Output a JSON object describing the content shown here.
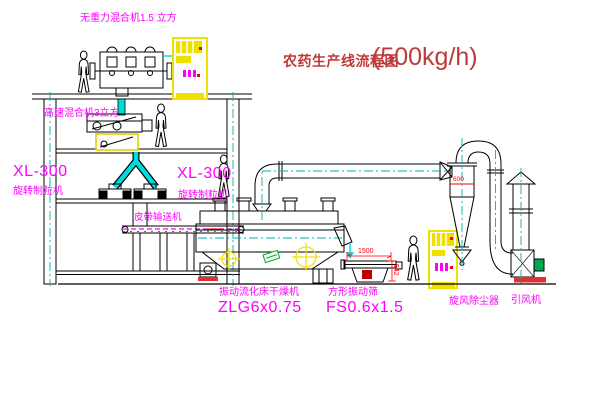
{
  "meta": {
    "type": "cad-process-flow-diagram",
    "canvas": {
      "width": 600,
      "height": 403
    },
    "background": "#FFFFFF"
  },
  "title": {
    "text": "农药生产线流程图",
    "capacity": "(500kg/h)"
  },
  "labels": {
    "top_mixer": "无重力混合机1.5 立方",
    "mid_mixer": "高速混合机3立方",
    "granulator_left_model": "XL-300",
    "granulator_left_name": "旋转制粒机",
    "granulator_right_model": "XL-300",
    "granulator_right_name": "旋转制粒机",
    "belt_conveyor": "皮带输送机",
    "dryer_name": "振动流化床干燥机",
    "dryer_model": "ZLG6x0.75",
    "screen_name": "方形振动筛",
    "screen_model": "FS0.6x1.5",
    "cyclone_name": "旋风除尘器",
    "fan_name": "引风机"
  },
  "dimensions": {
    "screen_length": "1500",
    "screen_height": "542",
    "cyclone_line": "600"
  },
  "colors": {
    "label_magenta": "#FF00FF",
    "title_red": "#BE3A3A",
    "dimension_red": "#FF0000",
    "machine_yellow": "#F0E000",
    "pipe_cyan": "#00DCDC",
    "centerline_cyan": "#00AFAF",
    "motor_green": "#00A651",
    "line_black": "#000000"
  },
  "figures": {
    "worker_count": 4
  }
}
